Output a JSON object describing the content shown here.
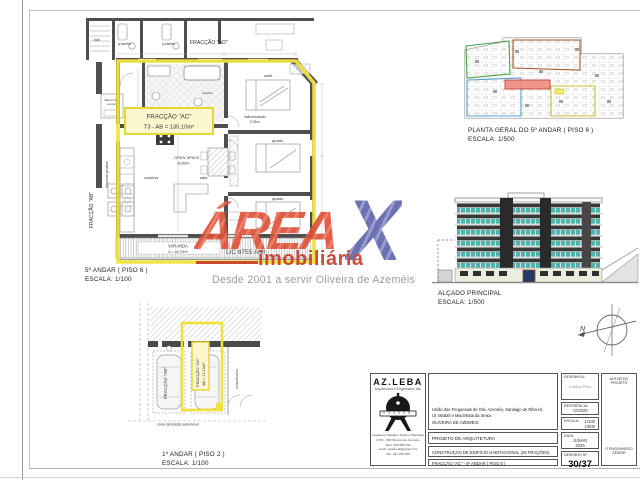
{
  "colors": {
    "highlight_yellow": "#efe33b",
    "label_fill": "#fcf7cf",
    "watermark_orange": "#dd4e37",
    "watermark_purple": "#5d62a9",
    "watermark_red": "#c8392b",
    "glazing_teal": "#4fb3ac",
    "plan_red_corridor": "#ef8a7f",
    "plan_green": "#44a048",
    "plan_brown": "#9a5a2a",
    "plan_blue": "#58a0c8",
    "plan_yellow": "#c8bc30"
  },
  "watermark": {
    "brand": "ÁREA",
    "x": "X",
    "sub": "imobiliária",
    "tagline": "Desde 2001 a servir Oliveira de Azeméis",
    "license": "LIC 6755 AMI"
  },
  "floor_plan": {
    "caption1": "5º ANDAR ( PISO 6 )",
    "caption2": "ESCALA: 1/100",
    "unit_line1": "FRACÇÃO \"AC\"",
    "unit_line2": "T3 - AB = 135,10m²",
    "rooms": {
      "hall": "hall",
      "qbanho": "q.banho",
      "qbanho2": "q.banho",
      "qbanho_suite": "q.banho",
      "fraccao_ad": "FRACÇÃO \"AD\"",
      "hall_entrada1": "hall entrada",
      "hall_entrada2": "comum",
      "despensa": "despensa privativa",
      "fraccao_ab": "FRACÇÃO \"AB\"",
      "cozinha": "cozinha",
      "open_space": "OPEN SPACE",
      "open_space_area": "43,00m²",
      "sala": "sala",
      "suite": "suite",
      "quarto1": "quarto",
      "quarto2": "quarto",
      "hall_circ": "hall/circulação",
      "hall_circ_area": "9,75m²",
      "varanda": "VARANDA",
      "varanda_area": "A = 16,70m²"
    }
  },
  "planta_geral": {
    "caption1": "PLANTA GERAL DO 5º ANDAR ( PISO 6 )",
    "caption2": "ESCALA: 1/500"
  },
  "alcado": {
    "caption1": "ALÇADO PRINCIPAL",
    "caption2": "ESCALA: 1/500"
  },
  "parking": {
    "caption1": "1º ANDAR ( PISO 2 )",
    "caption2": "ESCALA: 1/100",
    "space_line1": "FRACÇÃO \"AC\"",
    "space_line2": "AB = 14,15m²",
    "left_space": "FRACÇÃO \"AB\"",
    "zona_tecnica": "zona técnica",
    "zona_circulacao": "zona circulação automóvel"
  },
  "compass": {
    "north": "N"
  },
  "title_block": {
    "company": "AZ.LEBA",
    "company_sub": "Arquitectura e Engenharia, lda.",
    "address_lines": [
      "Arquitecto Salvador Tavares Machado",
      "3720 - 000 Oliveira de Azeméis",
      "Telef. 256 685 162",
      "email: azleba.al@gmail.com",
      "Tlm. 911 295 698"
    ],
    "municipality1": "União das Freguesias de Oliv. Azeméis, Santiago de Riba-Ul,",
    "municipality2": "Ul, Madaíl e Macinhata da Seixa",
    "municipality3": "OLIVEIRA DE AZEMÉIS",
    "project": "PROJETO DE ARQUITETURA",
    "construction": "CONSTRUÇÃO DE EDIFÍCIO HABITACIONAL (26 FRAÇÕES)",
    "fraction": "FRACÇÃO \"AC\" - 5º ANDAR ( PISO 6 )",
    "drew_label": "DESENHOU:",
    "drew_name": "Cristina Pires",
    "ref_label": "REFERÊNCIA:",
    "ref_value": "72/2020",
    "scale_label": "ESCALA:",
    "scale1": "1/100",
    "scale2": "1/500",
    "date_label": "DATA:",
    "date1": "JUNHO",
    "date2": "2025",
    "number_label": "DESENHO Nº:",
    "number_value": "30/37",
    "author_label": "AUTOR DO PROJETO",
    "engineer1": "O ENGENHEIRO",
    "engineer2": "SÉNIOR"
  }
}
